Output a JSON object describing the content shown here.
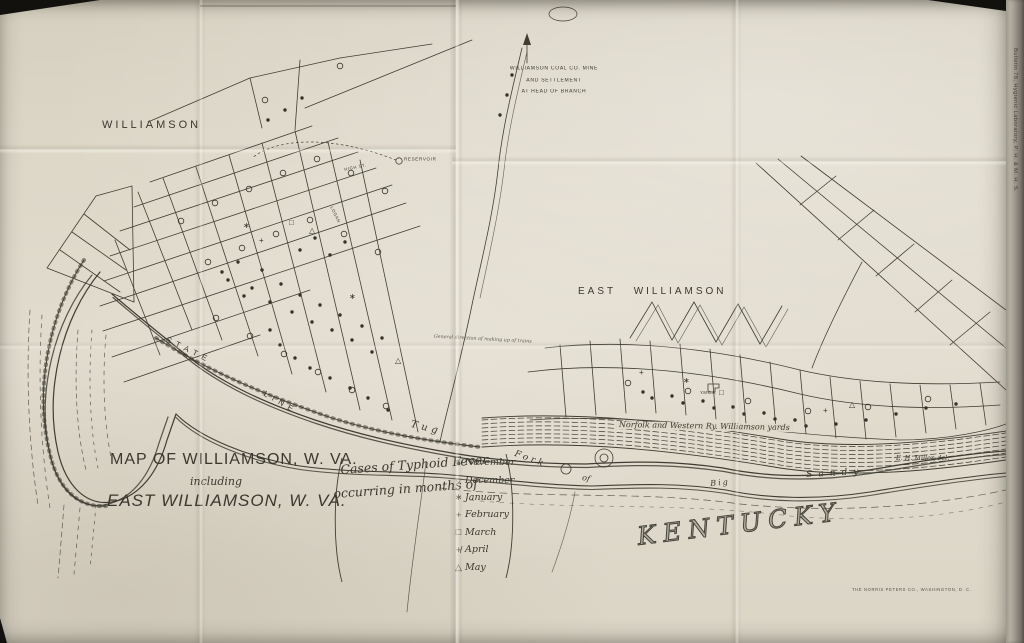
{
  "colors": {
    "paper": "#ded8c9",
    "ink": "#3a382e"
  },
  "title_block": {
    "line1": "MAP OF WILLIAMSON, W. VA.",
    "line2": "including",
    "line3": "EAST WILLIAMSON, W. VA."
  },
  "legend": {
    "caption_line1": "Cases of Typhoid Fever",
    "caption_line2": "occurring in months of",
    "items": [
      {
        "symbol": "●",
        "label": "November"
      },
      {
        "symbol": "○",
        "label": "December"
      },
      {
        "symbol": "∗",
        "label": "January"
      },
      {
        "symbol": "+",
        "label": "February"
      },
      {
        "symbol": "□",
        "label": "March"
      },
      {
        "symbol": "+̸",
        "label": "April"
      },
      {
        "symbol": "△",
        "label": "May"
      }
    ]
  },
  "map_labels": {
    "city": "WILLIAMSON",
    "east_city": "EAST WILLIAMSON",
    "kentucky": "KENTUCKY",
    "state_word": "STATE",
    "line_word": "LINE",
    "river_tug": "Tug",
    "river_fork": "Fork",
    "river_of": "of",
    "river_big": "Big",
    "river_sandy": "Sandy",
    "railroad": "Norfolk and Western Ry.   Williamson yards",
    "yard_note": "General direction of making up of trains",
    "reservoir": "RESERVOIR",
    "high_st": "HIGH ST.",
    "logan_st": "LOGAN",
    "ymca": "Y.M.C.A."
  },
  "mine_note": {
    "line1": "WILLIAMSON COAL CO. MINE",
    "line2": "AND SETTLEMENT",
    "line3": "AT HEAD OF BRANCH"
  },
  "credits": {
    "delineator": "E. H. Miller, del.",
    "printer": "THE NORRIS PETERS CO., WASHINGTON, D. C.",
    "spine": "Bulletin 78, Hygienic Laboratory, P. H. & M. H. S."
  }
}
